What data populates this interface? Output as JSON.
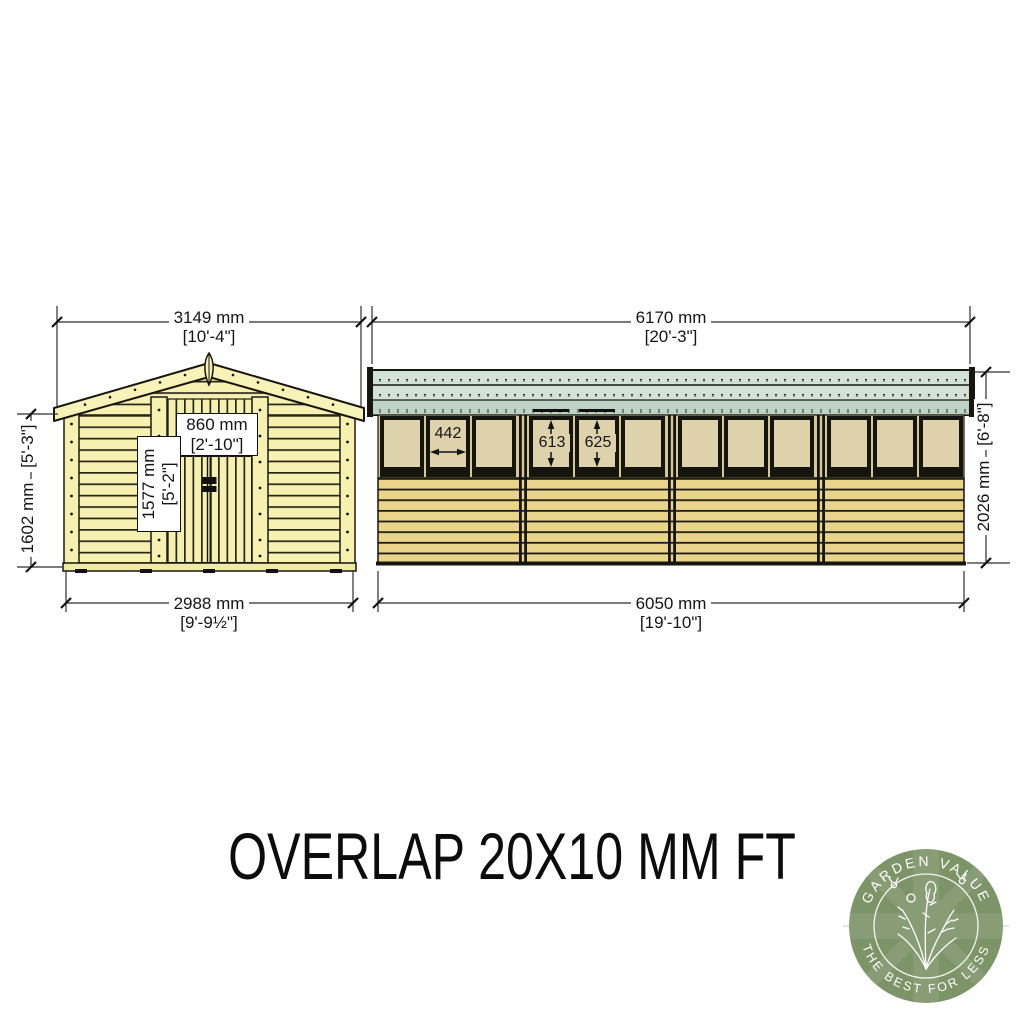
{
  "document": {
    "title": "OVERLAP 20X10 MM FT"
  },
  "front_elevation": {
    "overall_width": {
      "mm": "3149 mm",
      "imperial": "[10'-4\"]"
    },
    "wall_height": {
      "mm": "1602 mm",
      "imperial": "[5'-3\"]"
    },
    "door_width": {
      "mm": "860 mm",
      "imperial": "[2'-10\"]"
    },
    "door_height": {
      "mm": "1577 mm",
      "imperial": "[5'-2\"]"
    },
    "base_width": {
      "mm": "2988 mm",
      "imperial": "[9'-9½\"]"
    }
  },
  "side_elevation": {
    "overall_length": {
      "mm": "6170 mm",
      "imperial": "[20'-3\"]"
    },
    "eaves_height": {
      "mm": "2026 mm",
      "imperial": "[6'-8\"]"
    },
    "base_length": {
      "mm": "6050 mm",
      "imperial": "[19'-10\"]"
    },
    "window_width_mm": "442",
    "window_height_a_mm": "613",
    "window_height_b_mm": "625"
  },
  "logo": {
    "arc_top": "GARDEN VALUE",
    "arc_bottom": "THE BEST FOR LESS"
  },
  "colors": {
    "cladding_light": "#f6f1b0",
    "cladding_gold": "#ead48c",
    "window_tan": "#ded2ad",
    "wall_tan": "#d6c69c",
    "roof_green": "#d3e2d5",
    "roof_fascia_green": "#bed3c5",
    "logo_green": "#7d9468",
    "line": "#16160f"
  }
}
